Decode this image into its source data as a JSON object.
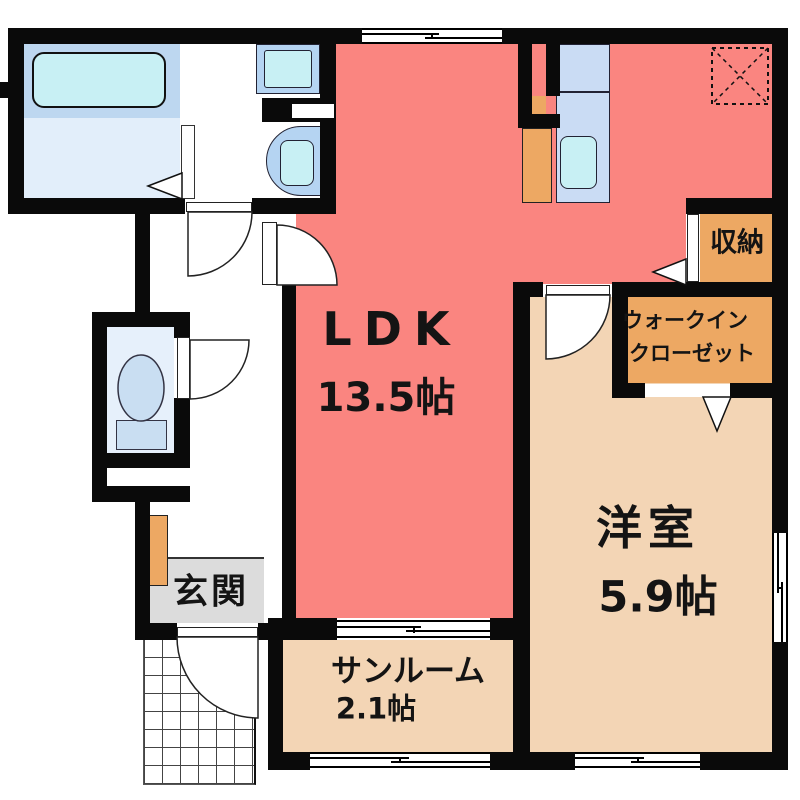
{
  "plan_title": "apartment-floor-plan",
  "rooms": {
    "ldk": {
      "label": "LDK",
      "size": "13.5帖"
    },
    "western_room": {
      "label": "洋室",
      "size": "5.9帖"
    },
    "sunroom": {
      "label": "サンルーム",
      "size": "2.1帖"
    },
    "entrance": {
      "label": "玄関"
    },
    "storage": {
      "label": "収納"
    },
    "walk_in_closet": {
      "label_line1": "ウォークイン",
      "label_line2": "クローゼット"
    }
  },
  "fixtures": [
    "bathtub",
    "washing-machine-pan",
    "washbasin",
    "toilet",
    "kitchen-counter",
    "kitchen-sink",
    "refrigerator-space",
    "shoe-cabinet",
    "equipment-space",
    "entrance-porch-hatch"
  ],
  "colors": {
    "wall": "#0a0a0a",
    "ldk_floor": "#fa8580",
    "room_floor": "#f3d5b5",
    "closet_floor": "#eda863",
    "entrance_floor": "#dcdcdc",
    "bath_floor": "#bdd7f0",
    "bath_wash_floor": "#e2eefa",
    "toilet_floor": "#e6f0fb",
    "fixture_blue": "#b5d4f2",
    "fixture_cyan": "#c8f0f4",
    "counter_blue": "#cadcf4",
    "tank_blue": "#c9def2"
  }
}
